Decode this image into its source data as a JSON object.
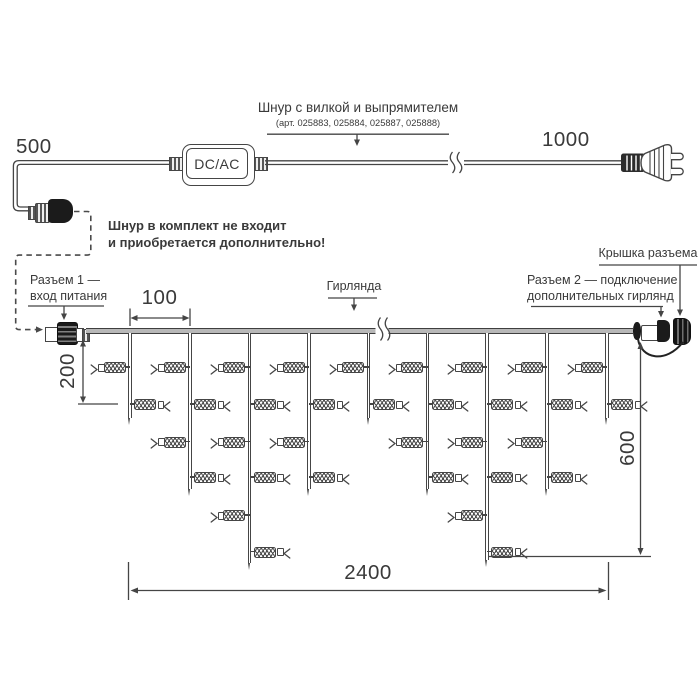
{
  "top": {
    "label_line1": "Шнур с вилкой и выпрямителем",
    "label_line2": "(арт. 025883, 025884, 025887, 025888)",
    "dim_500": "500",
    "dim_1000": "1000",
    "adapter": "DC/AC"
  },
  "note": {
    "line1": "Шнур в комплект не входит",
    "line2": "и приобретается дополнительно!"
  },
  "callouts": {
    "connector1_line1": "Разъем 1 —",
    "connector1_line2": "вход питания",
    "garland": "Гирлянда",
    "cap": "Крышка разъема",
    "connector2_line1": "Разъем 2 — подключение",
    "connector2_line2": "дополнительных гирлянд"
  },
  "dims": {
    "d100": "100",
    "d200": "200",
    "d600": "600",
    "d2400": "2400"
  },
  "colors": {
    "line": "#454545",
    "text": "#3a3a3a",
    "wire_fill": "#b8b8b8",
    "connector_dark": "#1b1b1b"
  },
  "garland": {
    "wire_y": 328,
    "wire_x1": 86,
    "wire_x2": 633,
    "bulb_rows_y": [
      367,
      404,
      441.5,
      477,
      515,
      551.5
    ],
    "drops": [
      {
        "x": 130,
        "bulbs": 2,
        "tip_y": 425
      },
      {
        "x": 190,
        "bulbs": 4,
        "tip_y": 496
      },
      {
        "x": 249.5,
        "bulbs": 6,
        "tip_y": 570
      },
      {
        "x": 309,
        "bulbs": 4,
        "tip_y": 496
      },
      {
        "x": 368.5,
        "bulbs": 2,
        "tip_y": 425
      },
      {
        "x": 427.5,
        "bulbs": 4,
        "tip_y": 496
      },
      {
        "x": 487,
        "bulbs": 6,
        "tip_y": 567
      },
      {
        "x": 547,
        "bulbs": 4,
        "tip_y": 496
      },
      {
        "x": 607,
        "bulbs": 2,
        "tip_y": 425
      }
    ]
  }
}
